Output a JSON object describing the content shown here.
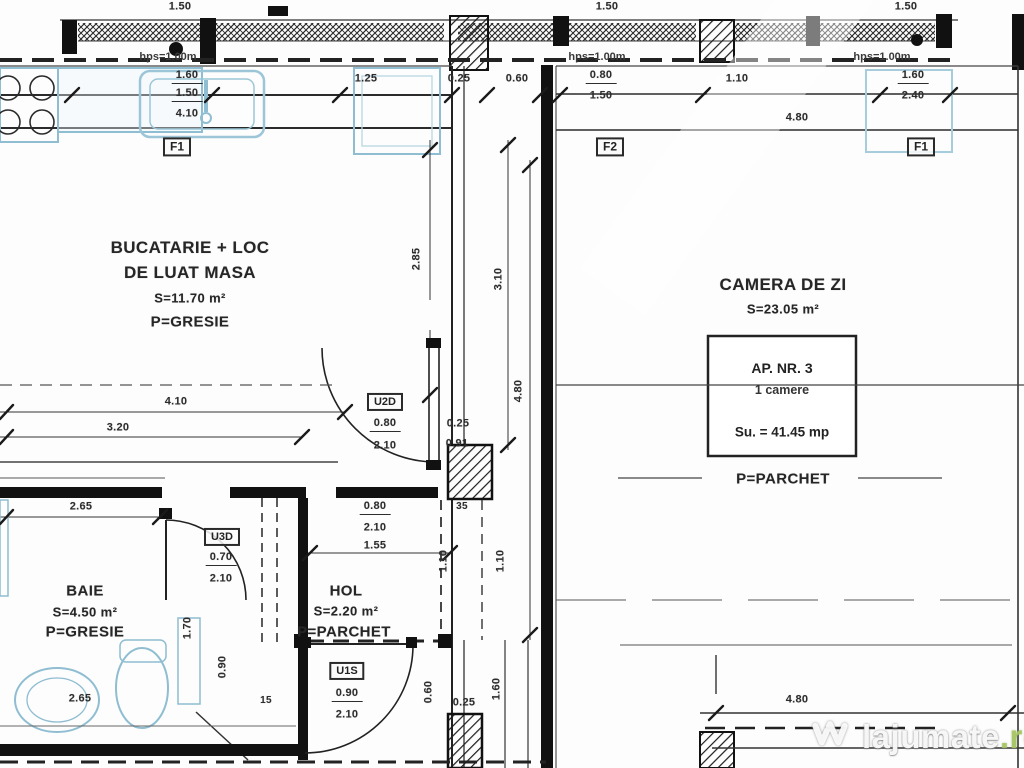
{
  "rooms": {
    "kitchen": {
      "line1": "BUCATARIE + LOC",
      "line2": "DE LUAT MASA",
      "area": "S=11.70 m²",
      "finish": "P=GRESIE"
    },
    "living": {
      "name": "CAMERA DE ZI",
      "area": "S=23.05 m²",
      "finish": "P=PARCHET"
    },
    "bath": {
      "name": "BAIE",
      "area": "S=4.50 m²",
      "finish": "P=GRESIE"
    },
    "hall": {
      "name": "HOL",
      "area": "S=2.20 m²",
      "finish": "P=PARCHET"
    }
  },
  "apartment": {
    "number": "AP. NR. 3",
    "type": "1 camere",
    "usable_area": "Su. = 41.45 mp"
  },
  "notes": {
    "parapet": "hps=1.00m"
  },
  "openings": {
    "f1_kitchen": "F1",
    "f2_living": "F2",
    "f1_living": "F1",
    "u2d": {
      "code": "U2D",
      "width": "0.80",
      "height": "2.10"
    },
    "u3d": {
      "code": "U3D",
      "width": "0.70",
      "height": "2.10"
    },
    "u1s": {
      "code": "U1S",
      "width": "0.90",
      "height": "2.10"
    }
  },
  "dims": [
    {
      "v": "1.50"
    },
    {
      "v": "1.50"
    },
    {
      "v": "1.50"
    },
    {
      "v": "1.60"
    },
    {
      "v": "1.50"
    },
    {
      "v": "4.10"
    },
    {
      "v": "1.25"
    },
    {
      "v": "0.25"
    },
    {
      "v": "0.60"
    },
    {
      "v": "0.80"
    },
    {
      "v": "1.50"
    },
    {
      "v": "1.10"
    },
    {
      "v": "1.60"
    },
    {
      "v": "2.40"
    },
    {
      "v": "4.80"
    },
    {
      "v": "2.85"
    },
    {
      "v": "3.10"
    },
    {
      "v": "4.80"
    },
    {
      "v": "4.10"
    },
    {
      "v": "3.20"
    },
    {
      "v": "2.65"
    },
    {
      "v": "0.25"
    },
    {
      "v": "0.91"
    },
    {
      "v": "35"
    },
    {
      "v": "0.80"
    },
    {
      "v": "2.10"
    },
    {
      "v": "1.55"
    },
    {
      "v": "1.10"
    },
    {
      "v": "1.10"
    },
    {
      "v": "1.70"
    },
    {
      "v": "0.90"
    },
    {
      "v": "2.65"
    },
    {
      "v": "15"
    },
    {
      "v": "0.60"
    },
    {
      "v": "0.25"
    },
    {
      "v": "1.60"
    },
    {
      "v": "4.80"
    }
  ],
  "watermark": {
    "brand": "lajumate",
    "tld": ".ro"
  },
  "colors": {
    "wall": "#111111",
    "fixture": "#8fbdd1",
    "text": "#2d2d2d",
    "watermark_green": "#a5c65f"
  }
}
